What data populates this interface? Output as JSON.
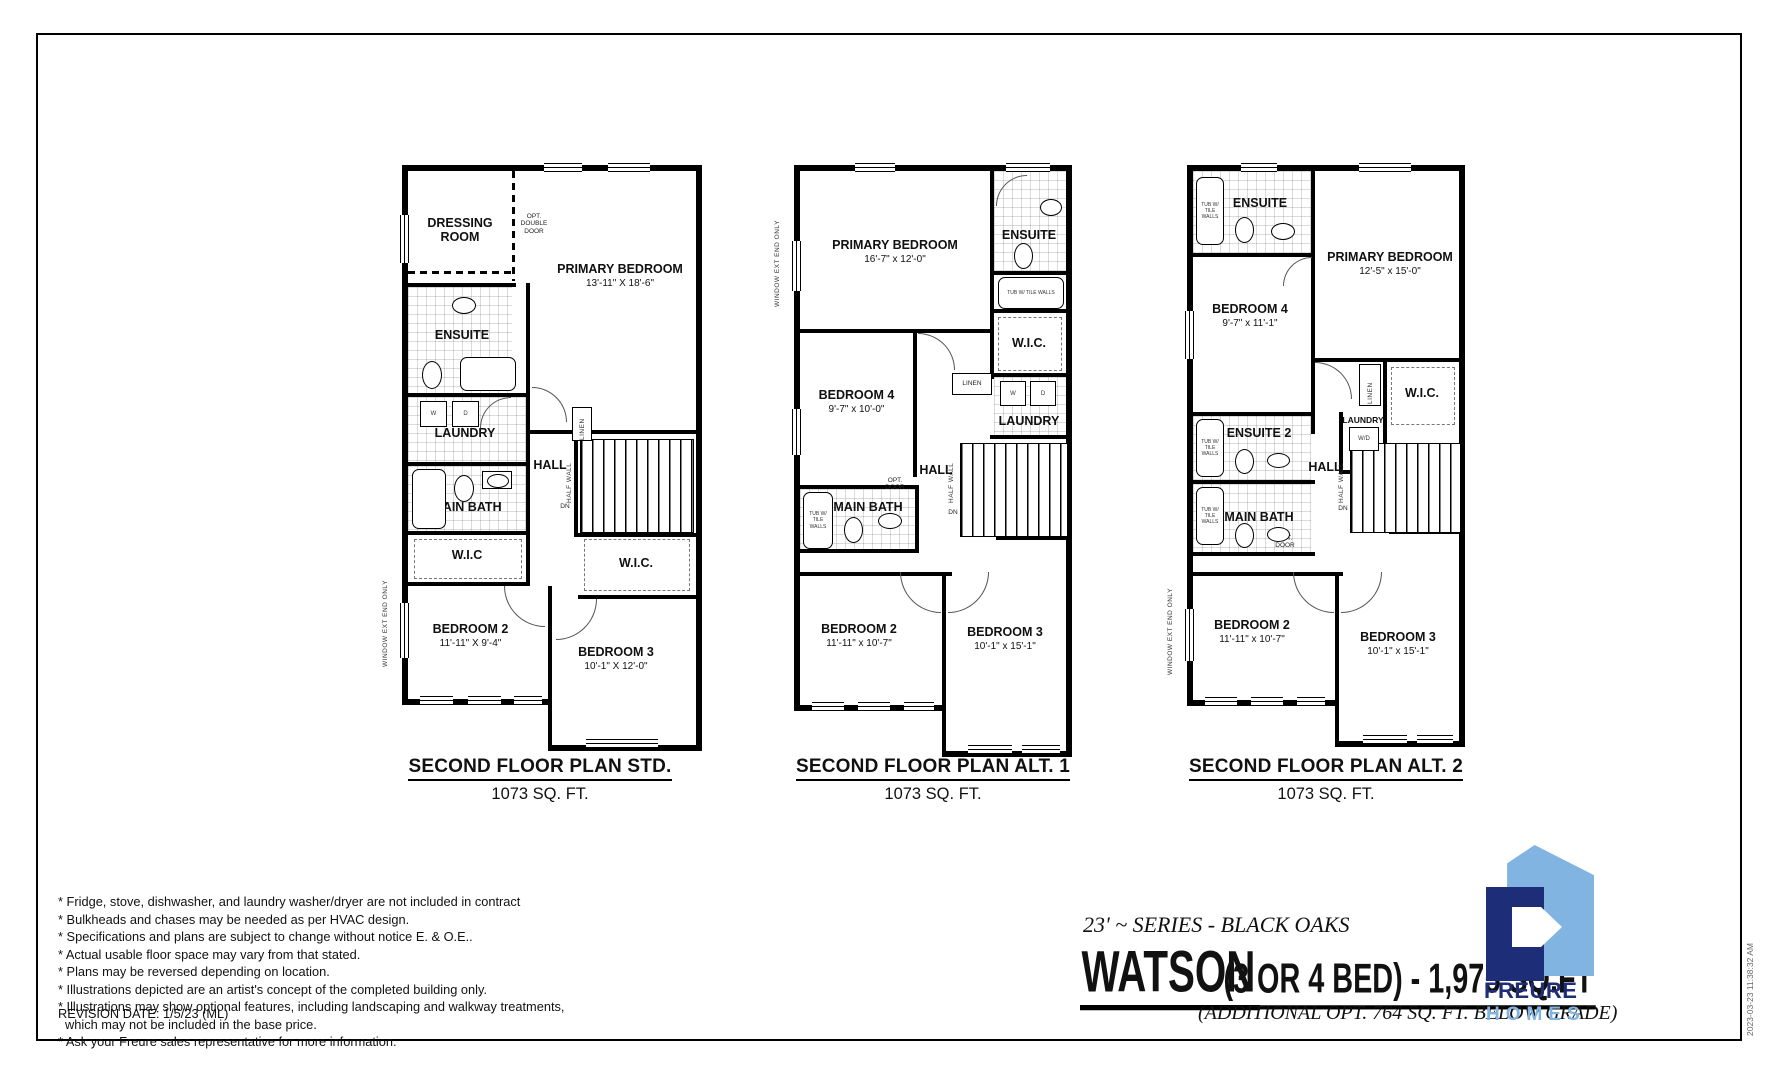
{
  "title_block": {
    "series": "23' ~ SERIES - BLACK OAKS",
    "model": "WATSON",
    "spec": "(3 OR 4 BED) - 1,975 SQ.FT",
    "additional": "(ADDITIONAL OPT. 764 SQ. FT. BELOW GRADE)",
    "logo": {
      "line1": "FREURE",
      "line2": "HOMES",
      "navy": "#1e2d78",
      "light_blue": "#82b4e1"
    },
    "timestamp": "2023-03-23 11:38:32 AM"
  },
  "footer": {
    "notes": [
      "* Fridge, stove, dishwasher, and laundry washer/dryer are not included in contract",
      "* Bulkheads and chases may be needed as per HVAC design.",
      "* Specifications and plans are subject to change without notice E. & O.E..",
      "* Actual usable floor space may vary from that stated.",
      "* Plans may be reversed depending on location.",
      "* Illustrations depicted are an artist's concept of the completed building only.",
      "* Illustrations may show optional features, including landscaping and walkway treatments,",
      "which may not be included in the base price.",
      "* Ask your Freure sales representative for more information."
    ],
    "revision": "REVISION DATE: 1/5/23 (ML)"
  },
  "shared": {
    "tub_note": "TUB W/ TILE WALLS",
    "half_wall": "HALF WALL",
    "dn": "DN",
    "window_note": "WINDOW EXT END ONLY",
    "washer": "W",
    "dryer": "D",
    "wd": "W/D",
    "linen": "LINEN",
    "hall": "HALL"
  },
  "plans": [
    {
      "caption": "SECOND FLOOR PLAN STD.",
      "area": "1073 SQ. FT.",
      "rooms": {
        "dressing": {
          "name": "DRESSING ROOM"
        },
        "primary": {
          "name": "PRIMARY BEDROOM",
          "dims": "13'-11\" X 18'-6\""
        },
        "ensuite": {
          "name": "ENSUITE"
        },
        "laundry": {
          "name": "LAUNDRY"
        },
        "mainbath": {
          "name": "MAIN BATH"
        },
        "wic_left": {
          "name": "W.I.C"
        },
        "wic_right": {
          "name": "W.I.C."
        },
        "bedroom2": {
          "name": "BEDROOM 2",
          "dims": "11'-11\" X 9'-4\""
        },
        "bedroom3": {
          "name": "BEDROOM 3",
          "dims": "10'-1\" X 12'-0\""
        }
      },
      "notes": {
        "opt_double_door": "OPT. DOUBLE DOOR"
      }
    },
    {
      "caption": "SECOND FLOOR PLAN ALT. 1",
      "area": "1073 SQ. FT.",
      "rooms": {
        "primary": {
          "name": "PRIMARY BEDROOM",
          "dims": "16'-7\" x 12'-0\""
        },
        "ensuite": {
          "name": "ENSUITE"
        },
        "wic": {
          "name": "W.I.C."
        },
        "bedroom4": {
          "name": "BEDROOM 4",
          "dims": "9'-7\" x 10'-0\""
        },
        "laundry": {
          "name": "LAUNDRY"
        },
        "mainbath": {
          "name": "MAIN BATH"
        },
        "bedroom2": {
          "name": "BEDROOM 2",
          "dims": "11'-11\" x 10'-7\""
        },
        "bedroom3": {
          "name": "BEDROOM 3",
          "dims": "10'-1\" x 15'-1\""
        }
      },
      "notes": {
        "opt_door": "OPT. DOOR"
      }
    },
    {
      "caption": "SECOND FLOOR PLAN ALT. 2",
      "area": "1073 SQ. FT.",
      "rooms": {
        "ensuite": {
          "name": "ENSUITE"
        },
        "primary": {
          "name": "PRIMARY BEDROOM",
          "dims": "12'-5\" x 15'-0\""
        },
        "bedroom4": {
          "name": "BEDROOM 4",
          "dims": "9'-7\" x 11'-1\""
        },
        "wic": {
          "name": "W.I.C."
        },
        "laundry": {
          "name": "LAUNDRY"
        },
        "ensuite2": {
          "name": "ENSUITE 2"
        },
        "mainbath": {
          "name": "MAIN BATH"
        },
        "bedroom2": {
          "name": "BEDROOM 2",
          "dims": "11'-11\" x 10'-7\""
        },
        "bedroom3": {
          "name": "BEDROOM 3",
          "dims": "10'-1\" x 15'-1\""
        }
      },
      "notes": {
        "opt_door": "OPT. DOOR"
      }
    }
  ]
}
